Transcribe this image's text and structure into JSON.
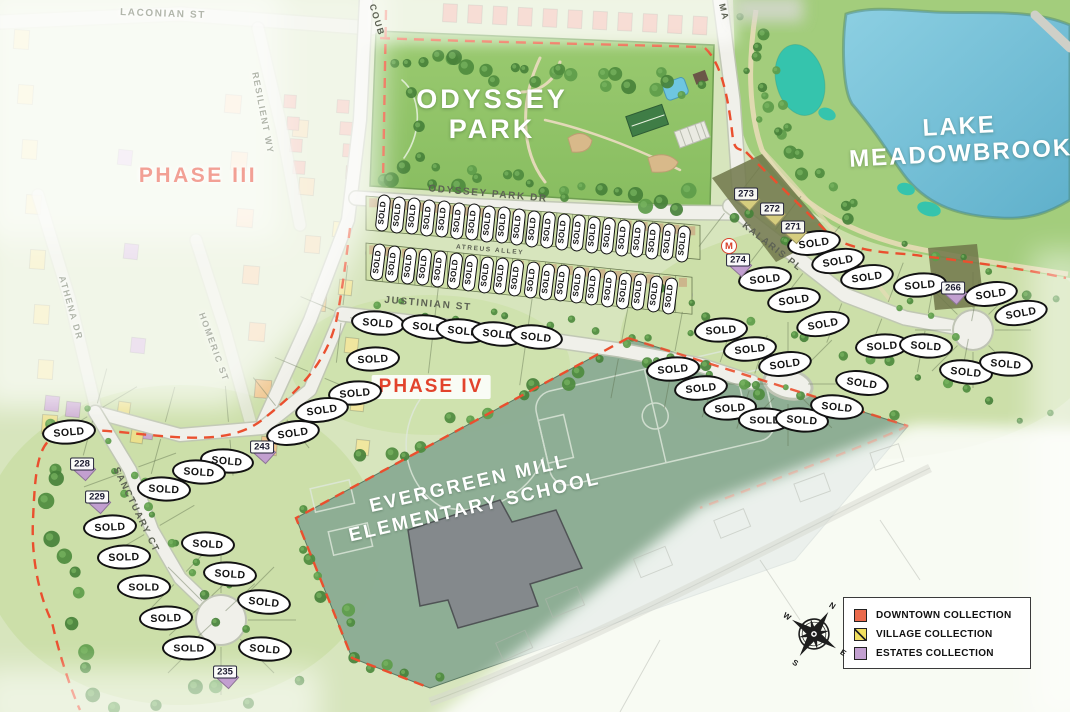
{
  "map": {
    "sold_label": "SOLD",
    "boundary_color": "#ea4f2e",
    "phase3": {
      "text": "PHASE III",
      "x": 198,
      "y": 176
    },
    "phase4": {
      "text": "PHASE IV",
      "x": 431,
      "y": 387
    },
    "park_label": {
      "line1": "ODYSSEY",
      "line2": "PARK",
      "x": 492,
      "y": 114,
      "rot": 0
    },
    "lake_label": {
      "line1": "LAKE",
      "line2": "MEADOWBROOK",
      "x": 960,
      "y": 140,
      "rot": -3
    },
    "school_label": {
      "line1": "EVERGREEN MILL",
      "line2": "ELEMENTARY SCHOOL",
      "x": 472,
      "y": 496,
      "rot": -13
    },
    "streets": [
      {
        "name": "LACONIAN ST",
        "x": 163,
        "y": 14,
        "rot": 2,
        "muted": true,
        "size": 10
      },
      {
        "name": "RESILIENT WY",
        "x": 263,
        "y": 113,
        "rot": 79,
        "muted": true,
        "size": 9
      },
      {
        "name": "ATHENA DR",
        "x": 71,
        "y": 308,
        "rot": 74,
        "muted": true,
        "size": 9
      },
      {
        "name": "HOMERIC ST",
        "x": 214,
        "y": 347,
        "rot": 70,
        "muted": true,
        "size": 9
      },
      {
        "name": "COUB",
        "x": 377,
        "y": 20,
        "rot": 73,
        "muted": false,
        "size": 9
      },
      {
        "name": "MA",
        "x": 724,
        "y": 12,
        "rot": 76,
        "muted": false,
        "size": 9
      },
      {
        "name": "ODYSSEY PARK DR",
        "x": 488,
        "y": 194,
        "rot": 5,
        "muted": false,
        "size": 10
      },
      {
        "name": "ATREUS ALLEY",
        "x": 490,
        "y": 250,
        "rot": 5,
        "muted": false,
        "size": 6.5
      },
      {
        "name": "JUSTINIAN ST",
        "x": 428,
        "y": 304,
        "rot": 5,
        "muted": false,
        "size": 10
      },
      {
        "name": "KALARIS PL",
        "x": 772,
        "y": 247,
        "rot": 38,
        "muted": false,
        "size": 9.5
      },
      {
        "name": "SANCTUARY CT",
        "x": 136,
        "y": 510,
        "rot": 64,
        "muted": false,
        "size": 9.5
      }
    ],
    "townhome_rows": [
      {
        "count": 21,
        "x1": 383,
        "y1": 213,
        "x2": 683,
        "y2": 244,
        "rot": -84
      },
      {
        "count": 20,
        "x1": 378,
        "y1": 262,
        "x2": 670,
        "y2": 296,
        "rot": -83
      }
    ],
    "sold_markers": [
      {
        "x": 814,
        "y": 243,
        "rot": -8
      },
      {
        "x": 838,
        "y": 261,
        "rot": -10
      },
      {
        "x": 867,
        "y": 277,
        "rot": -8
      },
      {
        "x": 920,
        "y": 285,
        "rot": -5
      },
      {
        "x": 991,
        "y": 294,
        "rot": -8
      },
      {
        "x": 1021,
        "y": 313,
        "rot": -10
      },
      {
        "x": 765,
        "y": 279,
        "rot": -6
      },
      {
        "x": 794,
        "y": 300,
        "rot": -8
      },
      {
        "x": 823,
        "y": 324,
        "rot": -10
      },
      {
        "x": 721,
        "y": 330,
        "rot": -4
      },
      {
        "x": 750,
        "y": 349,
        "rot": -6
      },
      {
        "x": 785,
        "y": 364,
        "rot": -8
      },
      {
        "x": 882,
        "y": 346,
        "rot": -4
      },
      {
        "x": 926,
        "y": 346,
        "rot": 4
      },
      {
        "x": 966,
        "y": 372,
        "rot": 6
      },
      {
        "x": 1006,
        "y": 364,
        "rot": 5
      },
      {
        "x": 862,
        "y": 383,
        "rot": 8
      },
      {
        "x": 673,
        "y": 369,
        "rot": -5
      },
      {
        "x": 701,
        "y": 388,
        "rot": -6
      },
      {
        "x": 730,
        "y": 408,
        "rot": -4
      },
      {
        "x": 765,
        "y": 420,
        "rot": 0
      },
      {
        "x": 802,
        "y": 420,
        "rot": 4
      },
      {
        "x": 837,
        "y": 407,
        "rot": 6
      },
      {
        "x": 378,
        "y": 323,
        "rot": 5
      },
      {
        "x": 428,
        "y": 327,
        "rot": 6
      },
      {
        "x": 463,
        "y": 331,
        "rot": 6
      },
      {
        "x": 498,
        "y": 334,
        "rot": 6
      },
      {
        "x": 536,
        "y": 337,
        "rot": 6
      },
      {
        "x": 373,
        "y": 359,
        "rot": -3
      },
      {
        "x": 355,
        "y": 393,
        "rot": -5
      },
      {
        "x": 322,
        "y": 410,
        "rot": -8
      },
      {
        "x": 293,
        "y": 433,
        "rot": -8
      },
      {
        "x": 69,
        "y": 432,
        "rot": -5
      },
      {
        "x": 227,
        "y": 461,
        "rot": 5
      },
      {
        "x": 199,
        "y": 472,
        "rot": 4
      },
      {
        "x": 164,
        "y": 489,
        "rot": 3
      },
      {
        "x": 110,
        "y": 527,
        "rot": -3
      },
      {
        "x": 124,
        "y": 557,
        "rot": -2
      },
      {
        "x": 144,
        "y": 587,
        "rot": 0
      },
      {
        "x": 208,
        "y": 544,
        "rot": 3
      },
      {
        "x": 230,
        "y": 574,
        "rot": 4
      },
      {
        "x": 264,
        "y": 602,
        "rot": 6
      },
      {
        "x": 166,
        "y": 618,
        "rot": -2
      },
      {
        "x": 189,
        "y": 648,
        "rot": 0
      },
      {
        "x": 265,
        "y": 649,
        "rot": 5
      }
    ],
    "numbered_lots": [
      {
        "num": "273",
        "x": 746,
        "y": 194,
        "house": "#d6cd7e"
      },
      {
        "num": "272",
        "x": 772,
        "y": 209,
        "house": "#d6cd7e"
      },
      {
        "num": "271",
        "x": 793,
        "y": 227,
        "house": "#d6cd7e"
      },
      {
        "num": "274",
        "x": 738,
        "y": 260,
        "house": "#c29fd0"
      },
      {
        "num": "266",
        "x": 953,
        "y": 288,
        "house": "#c29fd0"
      },
      {
        "num": "243",
        "x": 262,
        "y": 447,
        "house": "#c29fd0"
      },
      {
        "num": "228",
        "x": 82,
        "y": 464,
        "house": "#c29fd0"
      },
      {
        "num": "229",
        "x": 97,
        "y": 497,
        "house": "#c29fd0"
      },
      {
        "num": "235",
        "x": 225,
        "y": 672,
        "house": "#c29fd0"
      }
    ],
    "model_badge": {
      "label": "M",
      "x": 729,
      "y": 246
    }
  },
  "legend": {
    "items": [
      {
        "label": "DOWNTOWN COLLECTION",
        "color": "#ea6a4c",
        "pattern": "solid"
      },
      {
        "label": "VILLAGE COLLECTION",
        "color": "#f2df5f",
        "pattern": "diagonal"
      },
      {
        "label": "ESTATES COLLECTION",
        "color": "#c29fd0",
        "pattern": "solid"
      }
    ]
  },
  "compass": {
    "n": "N",
    "e": "E",
    "s": "S",
    "w": "W"
  }
}
